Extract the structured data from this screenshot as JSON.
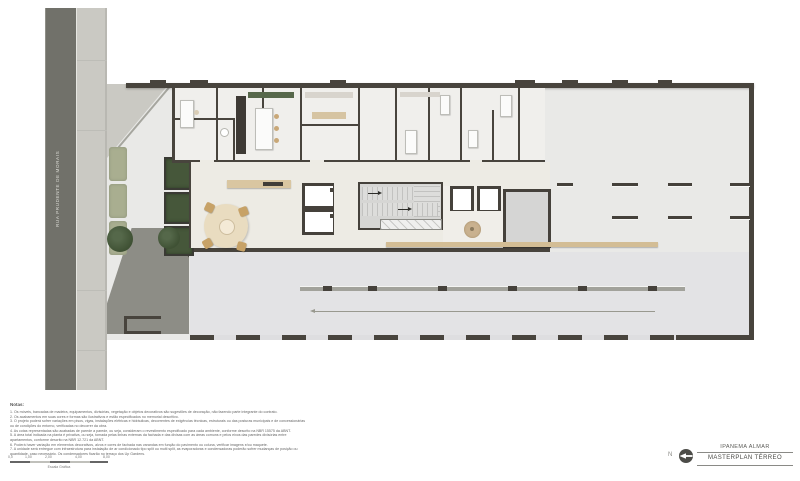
{
  "street": {
    "label": "RUA PRUDENTE DE MORAIS"
  },
  "title_block": {
    "project": "IPANEMA ALMAR",
    "sheet": "MASTERPLAN TÉRREO"
  },
  "north": {
    "label": "N",
    "icon": "compass-north-icon"
  },
  "notes": {
    "heading": "Notas:",
    "items": [
      "1. Os móveis, bancadas de madeira, equipamentos, divisórias, vegetação e objetos decorativos são sugestões de decoração, não fazendo parte integrante do contrato.",
      "2. Os acabamentos em suas cores e formas são ilustrativos e estão especificados no memorial descritivo.",
      "3. O projeto poderá sofrer variações em pisos, vigas, instalações elétricas e hidráulicas, decorrentes de exigências técnicas, estruturais ou das posturas municipais e de concessionárias ou de condições do entorno, verificadas no decorrer da obra.",
      "4. As cotas representadas são acabadas de parede a parede, ou seja, consideram o revestimento especificado para cada ambiente, conforme descrito na NBR 15575 da ABNT.",
      "5. A área total indicada na planta é privativa, ou seja, tomada pelas linhas externas da fachada e das divisas com as áreas comuns e pelos eixos das paredes divisórias entre apartamentos, conforme descrito na NBR 12.721 da ABNT.",
      "6. Poderá haver variação em elementos decorativos, alvos e cores de fachada nas varandas em função do pavimento ou coluna, verificar imagens e/ou maquete.",
      "7. A unidade será entregue com infraestrutura para instalação de ar condicionado tipo split ou multi split, as evaporadoras e condensadoras poderão sofrer mudanças de posição ou quantidade, caso necessário. Os condensadores ficarão no terraço dos Up Gardens."
    ]
  },
  "scale_bar": {
    "labels": [
      "0,0",
      "1,00",
      "2,00",
      "4,00",
      "8,00"
    ],
    "caption": "Escala Gráfica"
  },
  "colors": {
    "wall": "#48443d",
    "street": "#71716a",
    "sidewalk": "#cac9c3",
    "slab": "#e9e9e7",
    "lobby_floor": "#edebe4",
    "wood_accent": "#d3bd95",
    "vegetation_dark": "#46573a",
    "vegetation_light": "#a9ae90",
    "stair_gray": "#d6d6d4"
  }
}
